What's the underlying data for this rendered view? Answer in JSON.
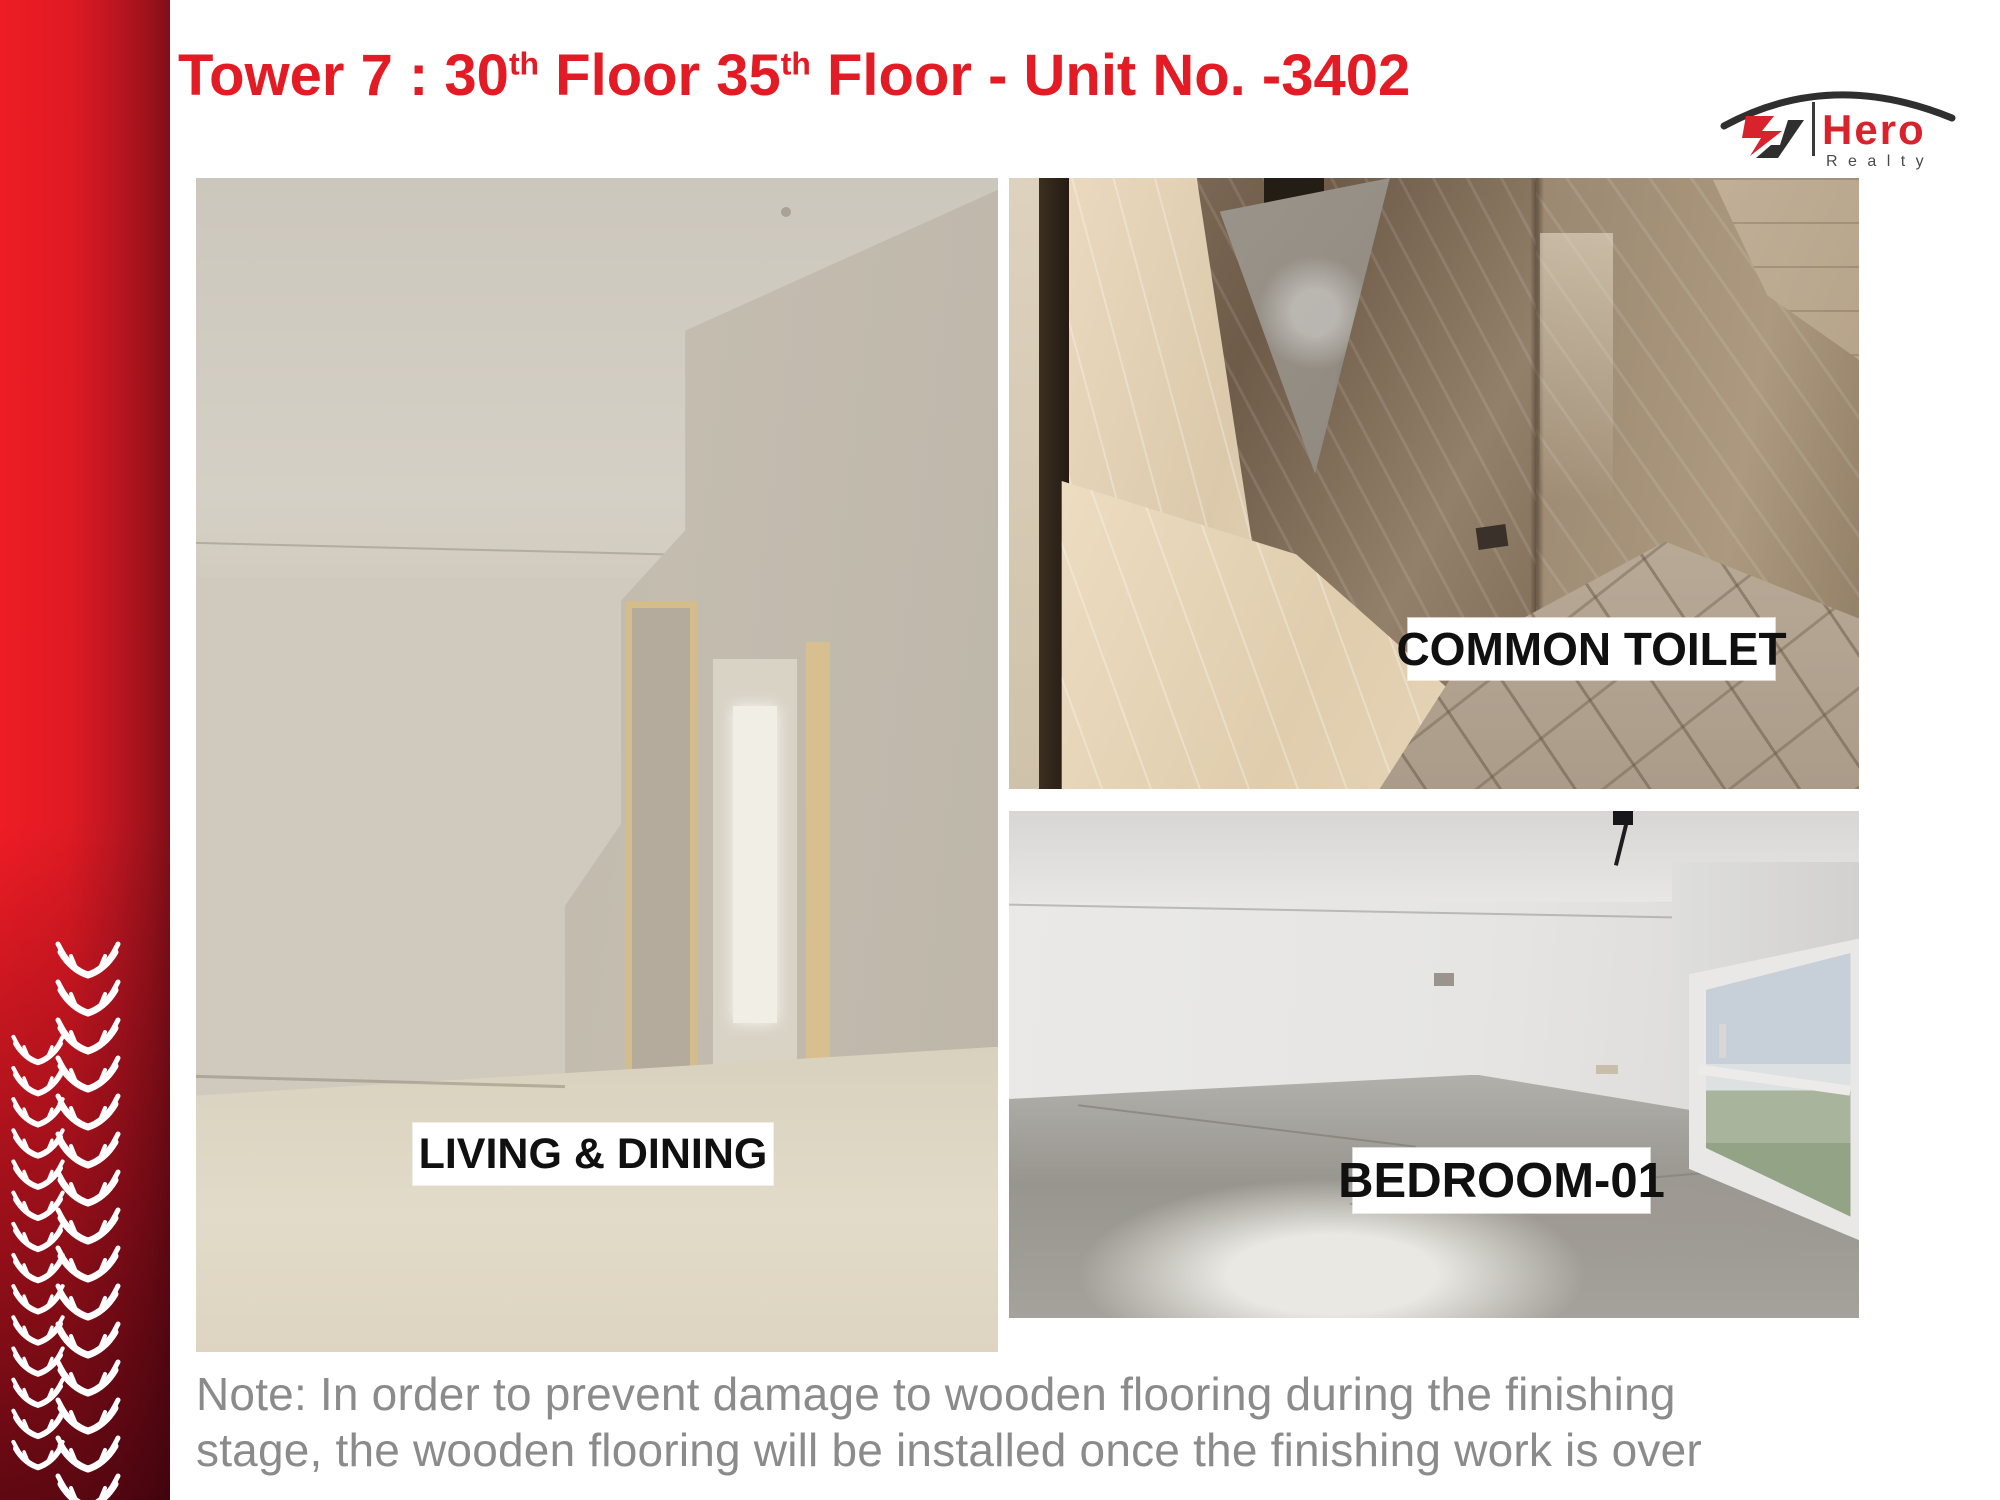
{
  "header": {
    "title": {
      "part1": "Tower 7 : 30",
      "sup1": "th",
      "part2": " Floor 35",
      "sup2": "th",
      "part3": " Floor - Unit No. -3402"
    }
  },
  "logo": {
    "brand": "Hero",
    "division": "R e a l t y"
  },
  "photos": {
    "living_dining": {
      "label": "LIVING & DINING"
    },
    "common_toilet": {
      "label": "COMMON TOILET"
    },
    "bedroom_01": {
      "label": "BEDROOM-01"
    }
  },
  "note": {
    "line1": "Note: In order to prevent damage to wooden flooring during the finishing",
    "line2": "stage, the wooden flooring will be installed once the finishing work is over"
  },
  "colors": {
    "accent_red": "#e31b24",
    "sideband_red_bright": "#ee1c25",
    "sideband_red_dark": "#7e0f18",
    "note_gray": "#8b8b8b",
    "label_background": "#ffffff",
    "label_text": "#101010",
    "logo_red": "#d8232c",
    "logo_dark": "#2f2f2f"
  }
}
